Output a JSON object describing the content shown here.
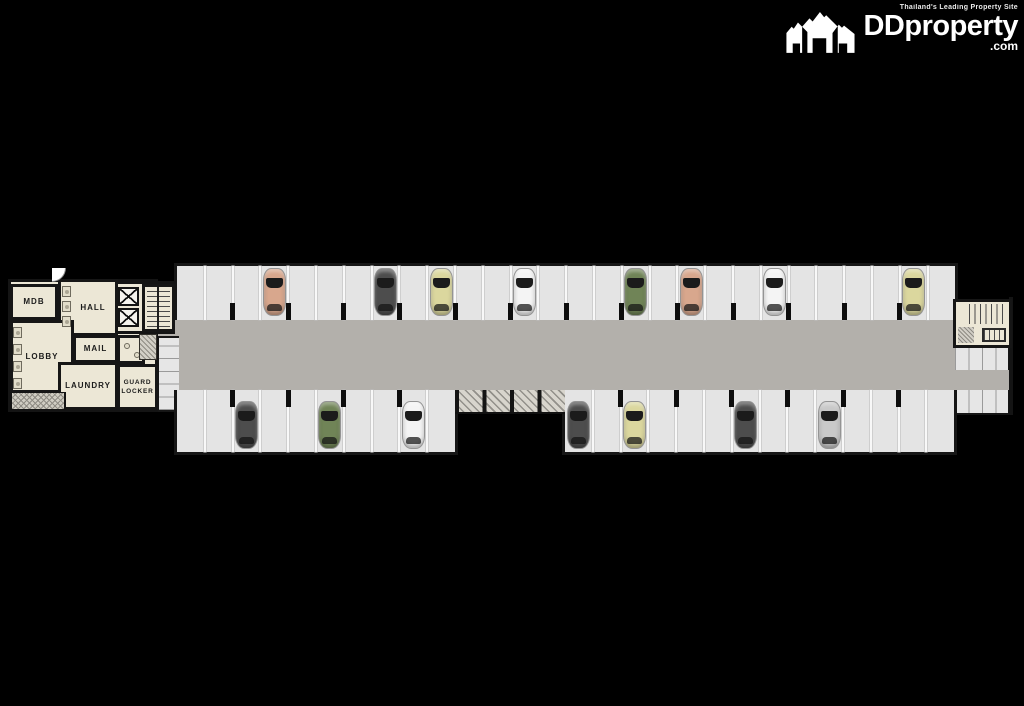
{
  "branding": {
    "tagline": "Thailand's Leading Property Site",
    "logo": "DDproperty",
    "logo_tld": ".com"
  },
  "rooms": {
    "mdb": "MDB",
    "hall": "HALL",
    "lobby": "LOBBY",
    "mail": "MAIL",
    "laundry": "LAUNDRY",
    "guard": "GUARD LOCKER"
  },
  "parking": {
    "rows": [
      {
        "id": "top",
        "stalls": 28,
        "x": 177,
        "y": 266,
        "stall_w": 27.8,
        "depth": 54,
        "side": "top"
      },
      {
        "id": "bottom-left",
        "stalls": 10,
        "x": 177,
        "y": 390,
        "stall_w": 27.8,
        "depth": 62,
        "side": "bottom"
      },
      {
        "id": "bottom-right",
        "stalls": 14,
        "x": 565,
        "y": 390,
        "stall_w": 27.8,
        "depth": 62,
        "side": "bottom"
      }
    ],
    "cars": [
      {
        "row": "top",
        "stall": 3,
        "color": "salmon"
      },
      {
        "row": "top",
        "stall": 7,
        "color": "dark-gray"
      },
      {
        "row": "top",
        "stall": 9,
        "color": "pale-yellow"
      },
      {
        "row": "top",
        "stall": 12,
        "color": "white"
      },
      {
        "row": "top",
        "stall": 16,
        "color": "green"
      },
      {
        "row": "top",
        "stall": 18,
        "color": "salmon"
      },
      {
        "row": "top",
        "stall": 21,
        "color": "white"
      },
      {
        "row": "top",
        "stall": 26,
        "color": "pale-yellow"
      },
      {
        "row": "bottom-left",
        "stall": 2,
        "color": "dark-gray"
      },
      {
        "row": "bottom-left",
        "stall": 5,
        "color": "green"
      },
      {
        "row": "bottom-left",
        "stall": 8,
        "color": "white"
      },
      {
        "row": "bottom-right",
        "stall": 0,
        "color": "dark-gray"
      },
      {
        "row": "bottom-right",
        "stall": 2,
        "color": "pale-yellow"
      },
      {
        "row": "bottom-right",
        "stall": 6,
        "color": "dark-gray"
      },
      {
        "row": "bottom-right",
        "stall": 9,
        "color": "silver"
      }
    ],
    "car_colors": {
      "salmon": "#d8a78d",
      "dark-gray": "#4d4d4d",
      "pale-yellow": "#dbd79e",
      "white": "#f4f4f4",
      "green": "#708457",
      "silver": "#c9c9c9"
    }
  },
  "colors": {
    "background": "#000000",
    "room_floor": "#ece7d6",
    "stall_floor": "#e4e4e4",
    "driveway": "#b3b0ab",
    "wall": "#161616",
    "logo": "#ffffff"
  }
}
